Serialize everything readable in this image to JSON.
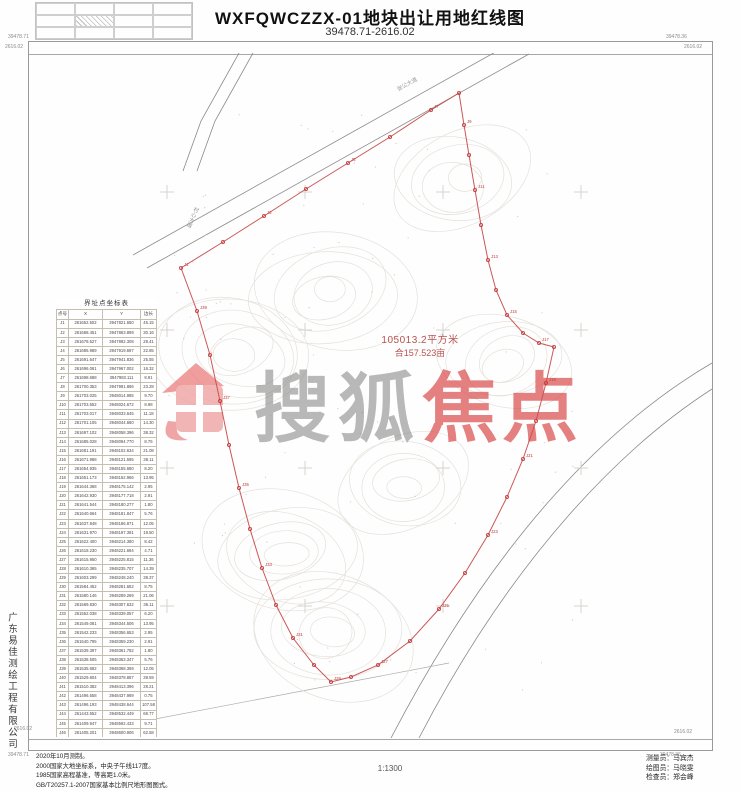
{
  "title": "WXFQWCZZX-01地块出让用地红线图",
  "subtitle": "39478.71-2616.02",
  "corners": {
    "tl_top": "39478.71",
    "tl_bottom": "2616.02",
    "tr_top": "39478.36",
    "tr_bottom": "2616.02",
    "bl_top": "2616.02",
    "bl_bottom": "39478.71",
    "br_top": "2616.02",
    "br_bottom": "39478.36"
  },
  "area": {
    "line1": "105013.2平方米",
    "line2": "合157.523亩"
  },
  "watermark": {
    "brand": "搜狐",
    "accent": "焦点"
  },
  "colors": {
    "boundary": "#c84e4e",
    "area_text": "#b8524e",
    "watermark_red": "#d94f4f",
    "watermark_gray": "#7d7d7d"
  },
  "scale": "1:1300",
  "notes": [
    "2020年10月测制。",
    "2000国家大地坐标系，中央子午线117度。",
    "1985国家高程基准，等高距1.0米。",
    "GB/T20257.1-2007国家基本比例尺地形图图式。"
  ],
  "credits": [
    "测量员：马宾杰",
    "绘图员：马晓雯",
    "检查员：郑会峰"
  ],
  "company_vertical": "广东易佳测绘工程有限公司",
  "coord_table": {
    "title": "界址点坐标表",
    "columns": [
      "点号",
      "X",
      "Y",
      "边长"
    ],
    "footer": "S=105013.2平方米  合157.523亩",
    "rows": [
      [
        "J1",
        "261652.502",
        "3947821.650",
        "45.15"
      ],
      [
        "J2",
        "261668.451",
        "3947863.899",
        "30.16"
      ],
      [
        "J3",
        "261678.527",
        "3947892.308",
        "28.41"
      ],
      [
        "J4",
        "261685.989",
        "3947919.697",
        "22.85"
      ],
      [
        "J5",
        "261691.647",
        "3947941.836",
        "25.55"
      ],
      [
        "J6",
        "261696.061",
        "3947967.002",
        "16.32"
      ],
      [
        "J7",
        "261698.688",
        "3947983.111",
        "8.91"
      ],
      [
        "J8",
        "261700.353",
        "3947991.866",
        "23.28"
      ],
      [
        "J9",
        "261703.025",
        "3948014.985",
        "9.70"
      ],
      [
        "J10",
        "261703.552",
        "3948024.672",
        "8.98"
      ],
      [
        "J11",
        "261703.017",
        "3948033.645",
        "11.18"
      ],
      [
        "J12",
        "261701.105",
        "3948044.660",
        "14.30"
      ],
      [
        "J13",
        "261697.102",
        "3948058.396",
        "38.32"
      ],
      [
        "J14",
        "261685.028",
        "3948094.770",
        "8.75"
      ],
      [
        "J15",
        "261681.191",
        "3948102.634",
        "21.08"
      ],
      [
        "J16",
        "261671.988",
        "3948121.595",
        "38.11"
      ],
      [
        "J17",
        "261654.935",
        "3948155.680",
        "8.20"
      ],
      [
        "J18",
        "261651.173",
        "3948162.966",
        "13.95"
      ],
      [
        "J19",
        "261644.368",
        "3948175.142",
        "2.95"
      ],
      [
        "J20",
        "261642.930",
        "3948177.718",
        "2.91"
      ],
      [
        "J21",
        "261641.544",
        "3948180.277",
        "1.80"
      ],
      [
        "J22",
        "261640.664",
        "3948181.847",
        "5.76"
      ],
      [
        "J23",
        "261637.848",
        "3948186.871",
        "12.05"
      ],
      [
        "J24",
        "261631.970",
        "3948197.391",
        "19.50"
      ],
      [
        "J25",
        "261622.400",
        "3948214.380",
        "8.42"
      ],
      [
        "J26",
        "261618.230",
        "3948221.694",
        "4.71"
      ],
      [
        "J27",
        "261615.950",
        "3948225.815",
        "11.36"
      ],
      [
        "J28",
        "261610.365",
        "3948235.707",
        "14.39"
      ],
      [
        "J29",
        "261603.299",
        "3948248.240",
        "38.37"
      ],
      [
        "J30",
        "261584.452",
        "3948281.652",
        "8.75"
      ],
      [
        "J31",
        "261580.146",
        "3948289.269",
        "21.06"
      ],
      [
        "J32",
        "261569.830",
        "3948307.632",
        "36.11"
      ],
      [
        "J33",
        "261552.038",
        "3948339.057",
        "6.20"
      ],
      [
        "J34",
        "261549.081",
        "3948344.506",
        "13.95"
      ],
      [
        "J35",
        "261542.233",
        "3948356.653",
        "2.95"
      ],
      [
        "J36",
        "261540.795",
        "3948359.230",
        "2.91"
      ],
      [
        "J37",
        "261539.397",
        "3948361.782",
        "1.80"
      ],
      [
        "J38",
        "261538.505",
        "3948363.347",
        "5.76"
      ],
      [
        "J39",
        "261535.682",
        "3948368.369",
        "12.05"
      ],
      [
        "J40",
        "261529.804",
        "3948378.887",
        "39.59"
      ],
      [
        "J41",
        "261510.382",
        "3948413.396",
        "28.21"
      ],
      [
        "J42",
        "261496.558",
        "3948437.989",
        "0.75"
      ],
      [
        "J43",
        "261496.193",
        "3948438.644",
        "107.58"
      ],
      [
        "J44",
        "261443.552",
        "3948532.449",
        "68.77"
      ],
      [
        "J45",
        "261409.947",
        "3948592.433",
        "9.71"
      ],
      [
        "J46",
        "261405.201",
        "3948600.906",
        "62.58"
      ],
      [
        "J47",
        "261374.644",
        "3948655.537",
        "65.82"
      ],
      [
        "J48",
        "261342.472",
        "3948712.969",
        "32.41"
      ],
      [
        "J49",
        "261326.678",
        "3948741.253",
        "38.34"
      ],
      [
        "J50",
        "261307.996",
        "3948774.756",
        "20.54"
      ]
    ]
  },
  "map": {
    "point_prefix": "J",
    "road_labels": [
      {
        "text": "村心大道"
      },
      {
        "text": "张公大道"
      }
    ],
    "boundary": [
      [
        152,
        215
      ],
      [
        194,
        189
      ],
      [
        235,
        163
      ],
      [
        277,
        136
      ],
      [
        319,
        110
      ],
      [
        361,
        84
      ],
      [
        402,
        57
      ],
      [
        430,
        40
      ],
      [
        435,
        72
      ],
      [
        440,
        102
      ],
      [
        446,
        137
      ],
      [
        452,
        172
      ],
      [
        459,
        207
      ],
      [
        467,
        237
      ],
      [
        478,
        262
      ],
      [
        494,
        280
      ],
      [
        510,
        290
      ],
      [
        525,
        294
      ],
      [
        517,
        330
      ],
      [
        507,
        368
      ],
      [
        494,
        406
      ],
      [
        478,
        444
      ],
      [
        459,
        482
      ],
      [
        436,
        520
      ],
      [
        410,
        556
      ],
      [
        381,
        588
      ],
      [
        349,
        612
      ],
      [
        322,
        624
      ],
      [
        302,
        629
      ],
      [
        285,
        612
      ],
      [
        264,
        585
      ],
      [
        247,
        552
      ],
      [
        233,
        515
      ],
      [
        221,
        476
      ],
      [
        210,
        435
      ],
      [
        200,
        392
      ],
      [
        191,
        348
      ],
      [
        181,
        302
      ],
      [
        168,
        258
      ]
    ]
  }
}
